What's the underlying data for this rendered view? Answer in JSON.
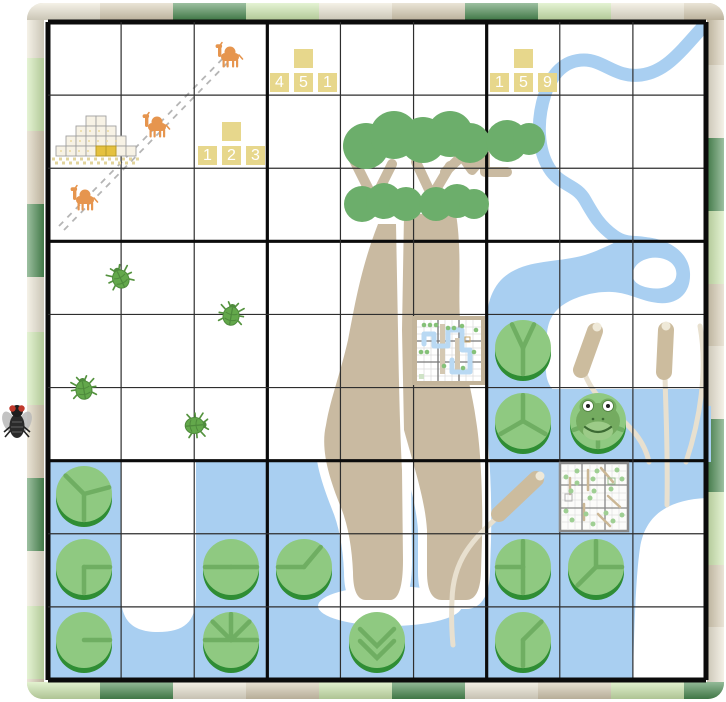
{
  "game": {
    "board": {
      "rows": 9,
      "cols": 9,
      "origin_x": 48,
      "origin_y": 22,
      "cell_size": 73.11
    },
    "clue_tile_groups": [
      {
        "name": "clue-451",
        "x": 270,
        "y": 49,
        "numbers": [
          "4",
          "5",
          "1"
        ]
      },
      {
        "name": "clue-123",
        "x": 198,
        "y": 122,
        "numbers": [
          "1",
          "2",
          "3"
        ]
      },
      {
        "name": "clue-159",
        "x": 490,
        "y": 49,
        "numbers": [
          "1",
          "5",
          "9"
        ]
      }
    ],
    "camels": [
      {
        "x": 230,
        "y": 55
      },
      {
        "x": 157,
        "y": 125
      },
      {
        "x": 85,
        "y": 198
      }
    ],
    "beetles": [
      {
        "x": 121,
        "y": 277,
        "rot": -25
      },
      {
        "x": 231,
        "y": 314,
        "rot": 10
      },
      {
        "x": 84,
        "y": 388,
        "rot": -10
      },
      {
        "x": 194,
        "y": 423,
        "rot": 85
      }
    ],
    "lily_pads": [
      {
        "x": 523,
        "y": 351,
        "veins": [
          65,
          115,
          270
        ]
      },
      {
        "x": 523,
        "y": 424,
        "veins": [
          90,
          210,
          330
        ]
      },
      {
        "x": 598,
        "y": 424,
        "veins": [
          200,
          270,
          340
        ],
        "has_frog": true
      },
      {
        "x": 84,
        "y": 497,
        "veins": [
          135,
          15,
          270
        ]
      },
      {
        "x": 84,
        "y": 570,
        "veins": [
          0,
          270
        ]
      },
      {
        "x": 84,
        "y": 643,
        "veins": [
          0
        ]
      },
      {
        "x": 231,
        "y": 570,
        "veins": [
          0,
          180
        ]
      },
      {
        "x": 231,
        "y": 643,
        "veins": [
          0,
          45,
          90,
          135,
          180
        ]
      },
      {
        "x": 304,
        "y": 570,
        "veins": [
          180,
          50
        ]
      },
      {
        "x": 377,
        "y": 643,
        "veins": [],
        "chevrons": true
      },
      {
        "x": 523,
        "y": 570,
        "veins": [
          90,
          180,
          270
        ]
      },
      {
        "x": 596,
        "y": 570,
        "veins": [
          90,
          0,
          225
        ]
      },
      {
        "x": 523,
        "y": 643,
        "veins": [
          45,
          270
        ]
      }
    ],
    "fly": {
      "x": 0,
      "y": 400
    },
    "icon_names": [
      "fly-icon",
      "camel-icon",
      "beetle-icon",
      "frog-icon",
      "lily-pad",
      "pyramid-icon",
      "mini-map-river-icon",
      "mini-map-reeds-icon",
      "baobab-tree",
      "cattail",
      "river",
      "pond",
      "clue-tiles"
    ],
    "colors": {
      "water": "#a9cff1",
      "canopy_green": "#6cae6b",
      "trunk_tan": "#c9baa1",
      "lily_green": "#8fc981",
      "lily_rim": "#2f8d34",
      "lily_vein": "#6fae62",
      "tile_yellow": "#e7d78c",
      "camel_orange": "#e6954e",
      "beetle_green": "#63a84b",
      "border_cream": "#ece6d4",
      "border_tan": "#d9ceb5",
      "border_dark_green": "#4c8c53",
      "border_light_green": "#cfe9b0"
    }
  }
}
